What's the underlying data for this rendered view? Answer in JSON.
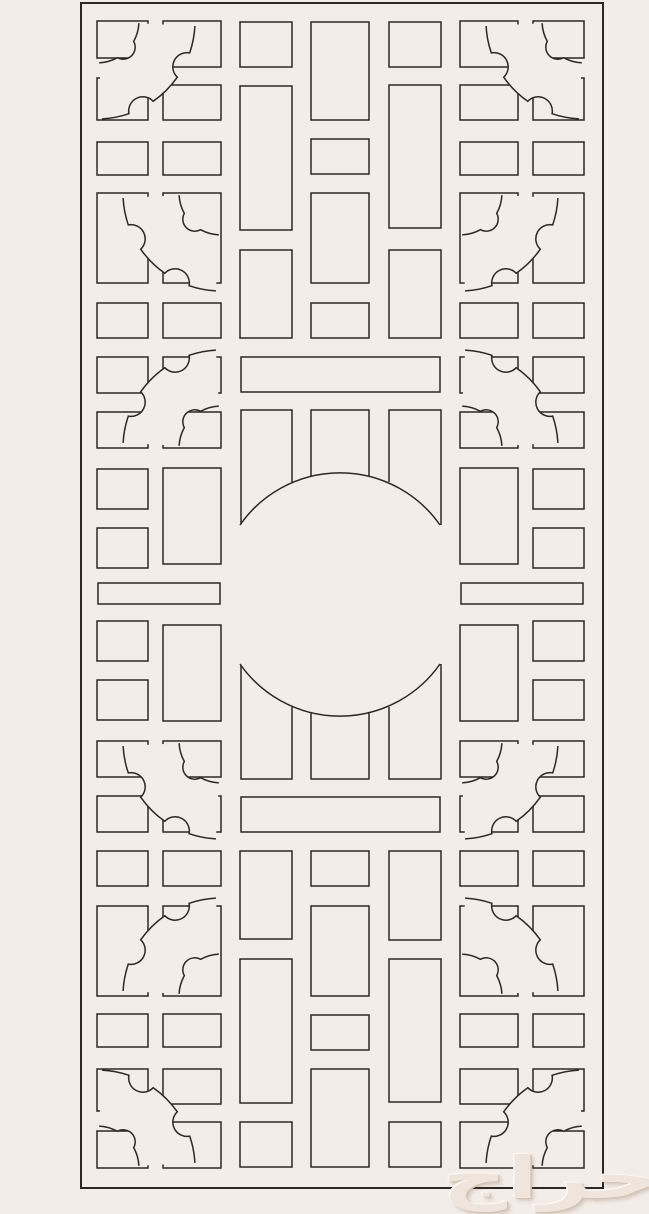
{
  "canvas": {
    "width": 649,
    "height": 1214,
    "background": "#f4ece6",
    "line_color": "#2e2722"
  },
  "border": {
    "x": 81,
    "y": 3,
    "width": 522,
    "height": 1185,
    "stroke_width": 2
  },
  "lattice": {
    "stroke_width": 1.5,
    "cells": [
      [
        97,
        21,
        51,
        37
      ],
      [
        97,
        78,
        51,
        42
      ],
      [
        97,
        142,
        51,
        33
      ],
      [
        97,
        193,
        51,
        90
      ],
      [
        97,
        303,
        51,
        35
      ],
      [
        97,
        357,
        51,
        36
      ],
      [
        97,
        412,
        51,
        36
      ],
      [
        97,
        469,
        51,
        40
      ],
      [
        97,
        528,
        51,
        40
      ],
      [
        97,
        621,
        51,
        40
      ],
      [
        97,
        680,
        51,
        40
      ],
      [
        97,
        741,
        51,
        36
      ],
      [
        97,
        796,
        51,
        36
      ],
      [
        97,
        851,
        51,
        35
      ],
      [
        97,
        906,
        51,
        90
      ],
      [
        97,
        1014,
        51,
        33
      ],
      [
        97,
        1069,
        51,
        42
      ],
      [
        97,
        1131,
        51,
        37
      ],
      [
        163,
        21,
        58,
        46
      ],
      [
        163,
        85,
        58,
        35
      ],
      [
        163,
        142,
        58,
        33
      ],
      [
        163,
        193,
        58,
        90
      ],
      [
        163,
        303,
        58,
        35
      ],
      [
        163,
        357,
        58,
        36
      ],
      [
        163,
        412,
        58,
        36
      ],
      [
        163,
        468,
        58,
        96
      ],
      [
        163,
        625,
        58,
        96
      ],
      [
        163,
        741,
        58,
        36
      ],
      [
        163,
        796,
        58,
        36
      ],
      [
        163,
        851,
        58,
        35
      ],
      [
        163,
        906,
        58,
        90
      ],
      [
        163,
        1014,
        58,
        33
      ],
      [
        163,
        1069,
        58,
        35
      ],
      [
        163,
        1122,
        58,
        46
      ],
      [
        240,
        22,
        52,
        45
      ],
      [
        240,
        86,
        52,
        144
      ],
      [
        240,
        250,
        52,
        88
      ],
      [
        240,
        851,
        52,
        88
      ],
      [
        240,
        959,
        52,
        144
      ],
      [
        240,
        1122,
        52,
        45
      ],
      [
        311,
        22,
        58,
        98
      ],
      [
        311,
        139,
        58,
        35
      ],
      [
        311,
        193,
        58,
        90
      ],
      [
        311,
        303,
        58,
        35
      ],
      [
        311,
        851,
        58,
        35
      ],
      [
        311,
        906,
        58,
        90
      ],
      [
        311,
        1015,
        58,
        35
      ],
      [
        311,
        1069,
        58,
        98
      ],
      [
        389,
        22,
        52,
        45
      ],
      [
        389,
        85,
        52,
        143
      ],
      [
        389,
        250,
        52,
        88
      ],
      [
        389,
        851,
        52,
        89
      ],
      [
        389,
        959,
        52,
        143
      ],
      [
        389,
        1122,
        52,
        45
      ],
      [
        460,
        21,
        58,
        46
      ],
      [
        460,
        85,
        58,
        35
      ],
      [
        460,
        142,
        58,
        33
      ],
      [
        460,
        193,
        58,
        90
      ],
      [
        460,
        303,
        58,
        35
      ],
      [
        460,
        357,
        58,
        36
      ],
      [
        460,
        412,
        58,
        36
      ],
      [
        460,
        468,
        58,
        96
      ],
      [
        460,
        625,
        58,
        96
      ],
      [
        460,
        741,
        58,
        36
      ],
      [
        460,
        796,
        58,
        36
      ],
      [
        460,
        851,
        58,
        35
      ],
      [
        460,
        906,
        58,
        90
      ],
      [
        460,
        1014,
        58,
        33
      ],
      [
        460,
        1069,
        58,
        35
      ],
      [
        460,
        1122,
        58,
        46
      ],
      [
        533,
        21,
        51,
        37
      ],
      [
        533,
        78,
        51,
        42
      ],
      [
        533,
        142,
        51,
        33
      ],
      [
        533,
        193,
        51,
        90
      ],
      [
        533,
        303,
        51,
        35
      ],
      [
        533,
        357,
        51,
        36
      ],
      [
        533,
        412,
        51,
        36
      ],
      [
        533,
        469,
        51,
        40
      ],
      [
        533,
        528,
        51,
        40
      ],
      [
        533,
        621,
        51,
        40
      ],
      [
        533,
        680,
        51,
        40
      ],
      [
        533,
        741,
        51,
        36
      ],
      [
        533,
        796,
        51,
        36
      ],
      [
        533,
        851,
        51,
        35
      ],
      [
        533,
        906,
        51,
        90
      ],
      [
        533,
        1014,
        51,
        33
      ],
      [
        533,
        1069,
        51,
        42
      ],
      [
        533,
        1131,
        51,
        37
      ]
    ],
    "bars": [
      [
        98,
        583,
        122,
        21
      ],
      [
        461,
        583,
        122,
        21
      ],
      [
        241,
        357,
        199,
        35
      ],
      [
        241,
        797,
        199,
        35
      ]
    ],
    "panels": [
      "M241,524 V410 H292 V482",
      "M311,476 V410 H369 V476",
      "M389,482 V410 H441 V525",
      "M241,665 V779 H292 V707",
      "M311,713 V779 H369 V713",
      "M389,707 V779 H441 V664"
    ],
    "circle_arcs": [
      "M240,525 A122,122 0 0 1 440,525",
      "M240,664 A122,122 0 0 0 440,664"
    ],
    "circle": {
      "cx": 340.5,
      "cy": 594.5,
      "r": 122
    },
    "cloud_inner_radius": 42,
    "cloud_outer_radius": 98,
    "clouds": [
      {
        "cx": 97,
        "cy": 21,
        "a0": 0,
        "a1": 90
      },
      {
        "cx": 221,
        "cy": 193,
        "a0": 90,
        "a1": 180
      },
      {
        "cx": 221,
        "cy": 448,
        "a0": 180,
        "a1": 270
      },
      {
        "cx": 221,
        "cy": 741,
        "a0": 90,
        "a1": 180
      },
      {
        "cx": 221,
        "cy": 996,
        "a0": 180,
        "a1": 270
      },
      {
        "cx": 97,
        "cy": 1168,
        "a0": 270,
        "a1": 360
      },
      {
        "cx": 584,
        "cy": 21,
        "a0": 90,
        "a1": 180
      },
      {
        "cx": 460,
        "cy": 193,
        "a0": 0,
        "a1": 90
      },
      {
        "cx": 460,
        "cy": 448,
        "a0": 270,
        "a1": 360
      },
      {
        "cx": 460,
        "cy": 741,
        "a0": 0,
        "a1": 90
      },
      {
        "cx": 460,
        "cy": 996,
        "a0": 270,
        "a1": 360
      },
      {
        "cx": 584,
        "cy": 1168,
        "a0": 180,
        "a1": 270
      }
    ]
  },
  "watermark": {
    "text": "حراج"
  }
}
